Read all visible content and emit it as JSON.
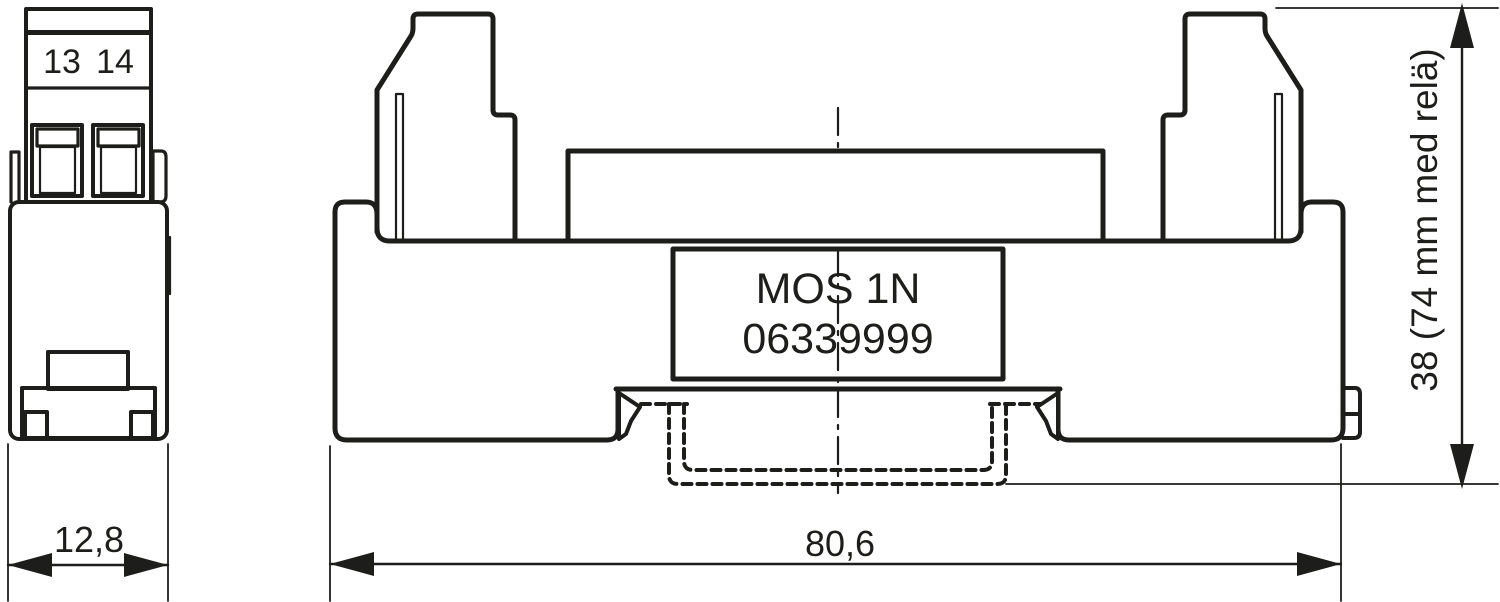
{
  "drawing": {
    "side_view": {
      "terminal_label_1": "13",
      "terminal_label_2": "14"
    },
    "front_view": {
      "product_label_line1": "MOS 1N",
      "product_label_line2": "06339999"
    },
    "dimensions": {
      "side_width": "12,8",
      "front_width": "80,6",
      "height": "38 (74 mm med relä)"
    },
    "colors": {
      "line": "#1d1d1b",
      "label_fill": "#d3d3d3",
      "terminal_fill": "#9c9c9c",
      "background": "#ffffff"
    }
  }
}
